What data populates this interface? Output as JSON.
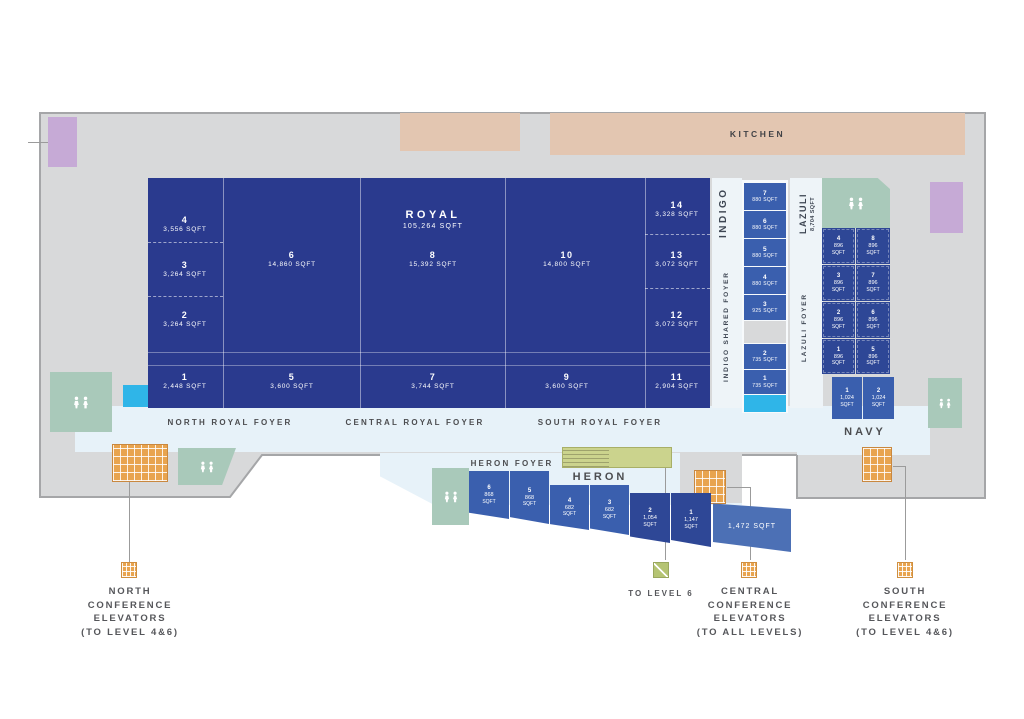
{
  "colors": {
    "royal": "#2a3a8e",
    "mid": "#3a5fae",
    "dark": "#2e4796",
    "annex": "#4c70b5",
    "cyan": "#2fb5e8",
    "plate": "#d8d9da",
    "foyer": "#e7f2f9",
    "sage": "#a9c9ba",
    "olive": "#cbd38d",
    "orange": "#e8a44f",
    "tan": "#e3c6b1",
    "purple": "#c6aad6",
    "label": "#55565a",
    "ink": "#4c4d50",
    "line": "#9b9b9b"
  },
  "kitchen": {
    "label": "KITCHEN"
  },
  "royal": {
    "title": "ROYAL",
    "title_sqft": "105,264 SQFT",
    "rooms": [
      {
        "num": "4",
        "sqft": "3,556 SQFT"
      },
      {
        "num": "3",
        "sqft": "3,264 SQFT"
      },
      {
        "num": "2",
        "sqft": "3,264 SQFT"
      },
      {
        "num": "1",
        "sqft": "2,448 SQFT"
      },
      {
        "num": "6",
        "sqft": "14,860 SQFT"
      },
      {
        "num": "5",
        "sqft": "3,600 SQFT"
      },
      {
        "num": "8",
        "sqft": "15,392 SQFT"
      },
      {
        "num": "7",
        "sqft": "3,744 SQFT"
      },
      {
        "num": "10",
        "sqft": "14,800 SQFT"
      },
      {
        "num": "9",
        "sqft": "3,600 SQFT"
      },
      {
        "num": "14",
        "sqft": "3,328 SQFT"
      },
      {
        "num": "13",
        "sqft": "3,072 SQFT"
      },
      {
        "num": "12",
        "sqft": "3,072 SQFT"
      },
      {
        "num": "11",
        "sqft": "2,904 SQFT"
      }
    ]
  },
  "foyers": {
    "north_royal": "NORTH ROYAL FOYER",
    "central_royal": "CENTRAL ROYAL FOYER",
    "south_royal": "SOUTH ROYAL FOYER",
    "heron": "HERON FOYER",
    "indigo_shared": "INDIGO SHARED FOYER",
    "lazuli": "LAZULI FOYER"
  },
  "indigo": {
    "label": "INDIGO",
    "rooms": [
      {
        "num": "7",
        "sqft": "880 SQFT"
      },
      {
        "num": "6",
        "sqft": "880 SQFT"
      },
      {
        "num": "5",
        "sqft": "880 SQFT"
      },
      {
        "num": "4",
        "sqft": "880 SQFT"
      },
      {
        "num": "3",
        "sqft": "925 SQFT"
      },
      {
        "num": "2",
        "sqft": "735 SQFT"
      },
      {
        "num": "1",
        "sqft": "735 SQFT"
      }
    ]
  },
  "lazuli": {
    "label": "LAZULI",
    "total_sqft": "8,704 SQFT",
    "rooms": [
      {
        "num": "4",
        "area": "896",
        "unit": "SQFT"
      },
      {
        "num": "8",
        "area": "896",
        "unit": "SQFT"
      },
      {
        "num": "3",
        "area": "896",
        "unit": "SQFT"
      },
      {
        "num": "7",
        "area": "896",
        "unit": "SQFT"
      },
      {
        "num": "2",
        "area": "896",
        "unit": "SQFT"
      },
      {
        "num": "6",
        "area": "896",
        "unit": "SQFT"
      },
      {
        "num": "1",
        "area": "896",
        "unit": "SQFT"
      },
      {
        "num": "5",
        "area": "896",
        "unit": "SQFT"
      }
    ]
  },
  "navy": {
    "label": "NAVY",
    "rooms": [
      {
        "num": "1",
        "area": "1,024",
        "unit": "SQFT"
      },
      {
        "num": "2",
        "area": "1,024",
        "unit": "SQFT"
      }
    ]
  },
  "heron": {
    "label": "HERON",
    "rooms": [
      {
        "num": "6",
        "area": "868",
        "unit": "SQFT"
      },
      {
        "num": "5",
        "area": "868",
        "unit": "SQFT"
      },
      {
        "num": "4",
        "area": "682",
        "unit": "SQFT"
      },
      {
        "num": "3",
        "area": "682",
        "unit": "SQFT"
      },
      {
        "num": "2",
        "area": "1,054",
        "unit": "SQFT"
      },
      {
        "num": "1",
        "area": "1,147",
        "unit": "SQFT"
      }
    ],
    "annex_sqft": "1,472 SQFT"
  },
  "legend": {
    "north": {
      "lines": [
        "NORTH",
        "CONFERENCE",
        "ELEVATORS",
        "(TO LEVEL 4&6)"
      ]
    },
    "to_level_6": {
      "label": "TO LEVEL 6"
    },
    "central": {
      "lines": [
        "CENTRAL",
        "CONFERENCE",
        "ELEVATORS",
        "(TO ALL LEVELS)"
      ]
    },
    "south": {
      "lines": [
        "SOUTH",
        "CONFERENCE",
        "ELEVATORS",
        "(TO LEVEL 4&6)"
      ]
    }
  }
}
